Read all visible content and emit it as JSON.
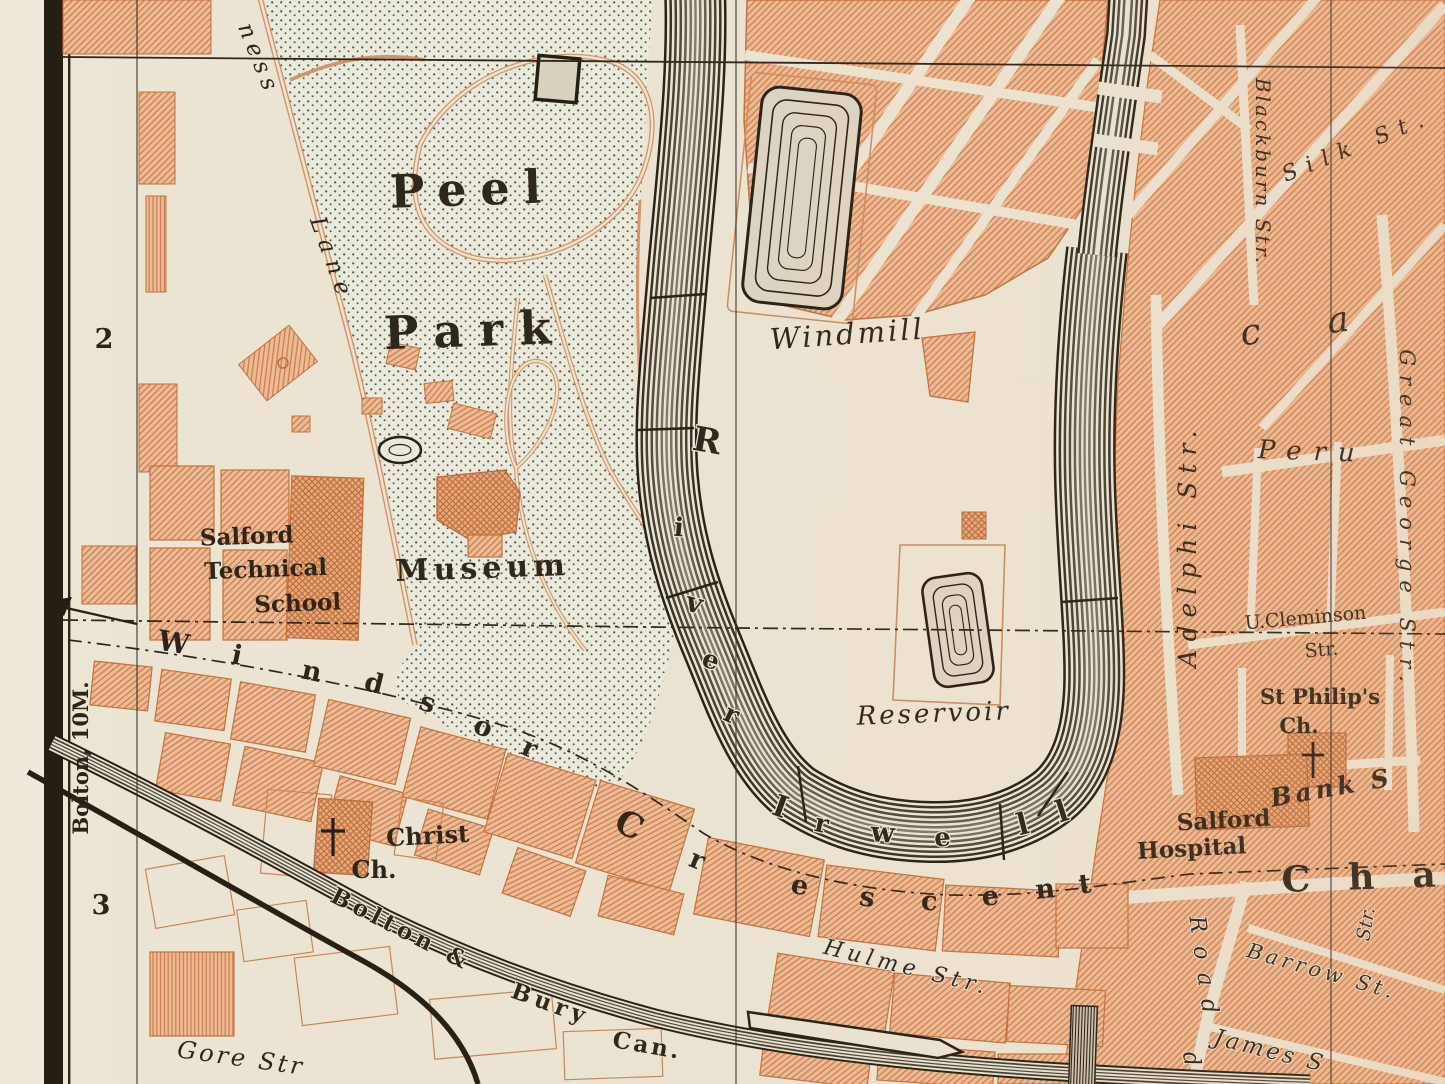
{
  "margin": {
    "row_label_top": "2",
    "row_label_bottom": "3",
    "direction_note": "Bolton, 10M."
  },
  "park": {
    "name_line1": "Peel",
    "name_line2": "Park",
    "museum": "Museum",
    "school_line1": "Salford",
    "school_line2": "Technical",
    "school_line3": "School",
    "lane_part1": "ness",
    "lane_part2": "Lane"
  },
  "water": {
    "river_upper": [
      "R",
      "i",
      "v",
      "e",
      "r"
    ],
    "river_lower": [
      "I",
      "r",
      "w",
      "e",
      "l",
      "l"
    ],
    "canal_part1": "Bolton &",
    "canal_part2": "Bury",
    "canal_part3": "Can."
  },
  "features": {
    "windmill": "Windmill",
    "reservoir": "Reservoir",
    "christ_line1": "Christ",
    "christ_line2": "Ch.",
    "hospital_line1": "Salford",
    "hospital_line2": "Hospital",
    "philips_line1": "St Philip's",
    "philips_line2": "Ch.",
    "bank": "Bank S"
  },
  "streets": {
    "windsor": [
      "W",
      "i",
      "n",
      "d",
      "s",
      "o",
      "r"
    ],
    "crescent": [
      "C",
      "r",
      "e",
      "s",
      "c",
      "e",
      "n",
      "t"
    ],
    "chapel_fragment": "Cha",
    "hulme": "Hulme Str.",
    "gore": "Gore Str",
    "cleminson_line1": "U.Cleminson",
    "cleminson_line2": "Str.",
    "peru": "Peru",
    "adelphi": "Adelphi Str.",
    "blackburn": "Blackburn Str.",
    "silk": "Silk St.",
    "great_george": "Great George Str.",
    "road": "Road",
    "road_fragment": "d",
    "barrow": "Barrow St.",
    "james": "James S",
    "str_fragment": "Str.",
    "large_letter_fragment": "c a"
  },
  "colors": {
    "paper": "#efe9dc",
    "ground": "#ebe5d4",
    "park_ground": "#e9ebdf",
    "building_fill": "#edbb95",
    "building_hatch": "#c97d4e",
    "building_outline": "#c4703c",
    "ink": "#2b241a",
    "water_ink": "#241e14"
  }
}
